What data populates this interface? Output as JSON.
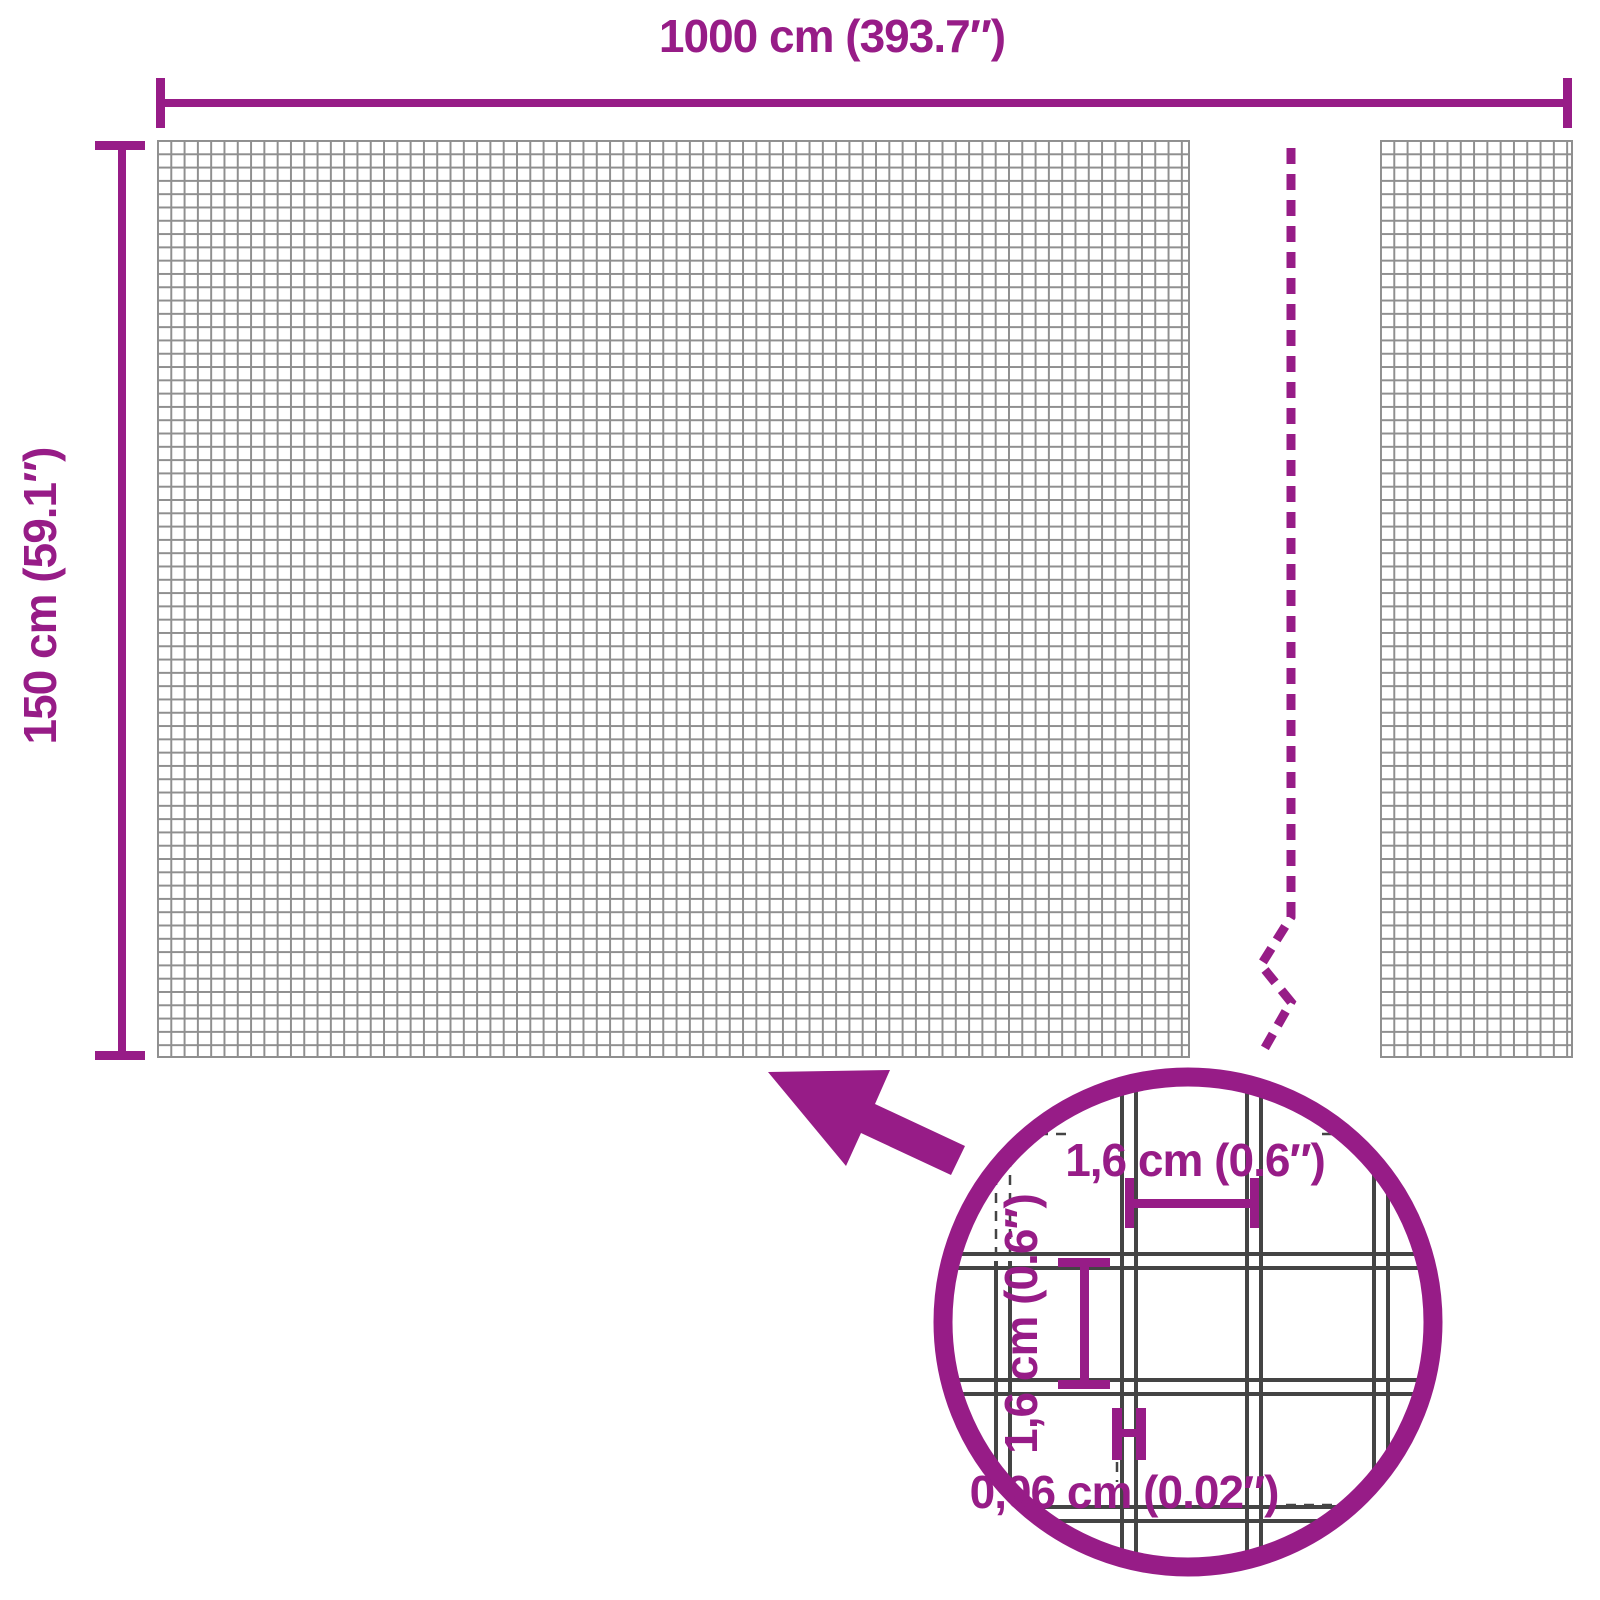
{
  "diagram": {
    "width_label": "1000 cm (393.7″)",
    "height_label": "150 cm (59.1″)",
    "detail": {
      "mesh_width_label": "1,6 cm (0.6″)",
      "mesh_height_label": "1,6 cm (0.6″)",
      "wire_thickness_label": "0,06 cm (0.02″)"
    },
    "colors": {
      "accent": "#971C87",
      "mesh_line": "#8F8F8F",
      "detail_wire": "#444444",
      "background": "#FFFFFF"
    },
    "icons": {
      "arrow": "zoom-arrow-icon",
      "magnifier": "magnifier-circle"
    }
  }
}
